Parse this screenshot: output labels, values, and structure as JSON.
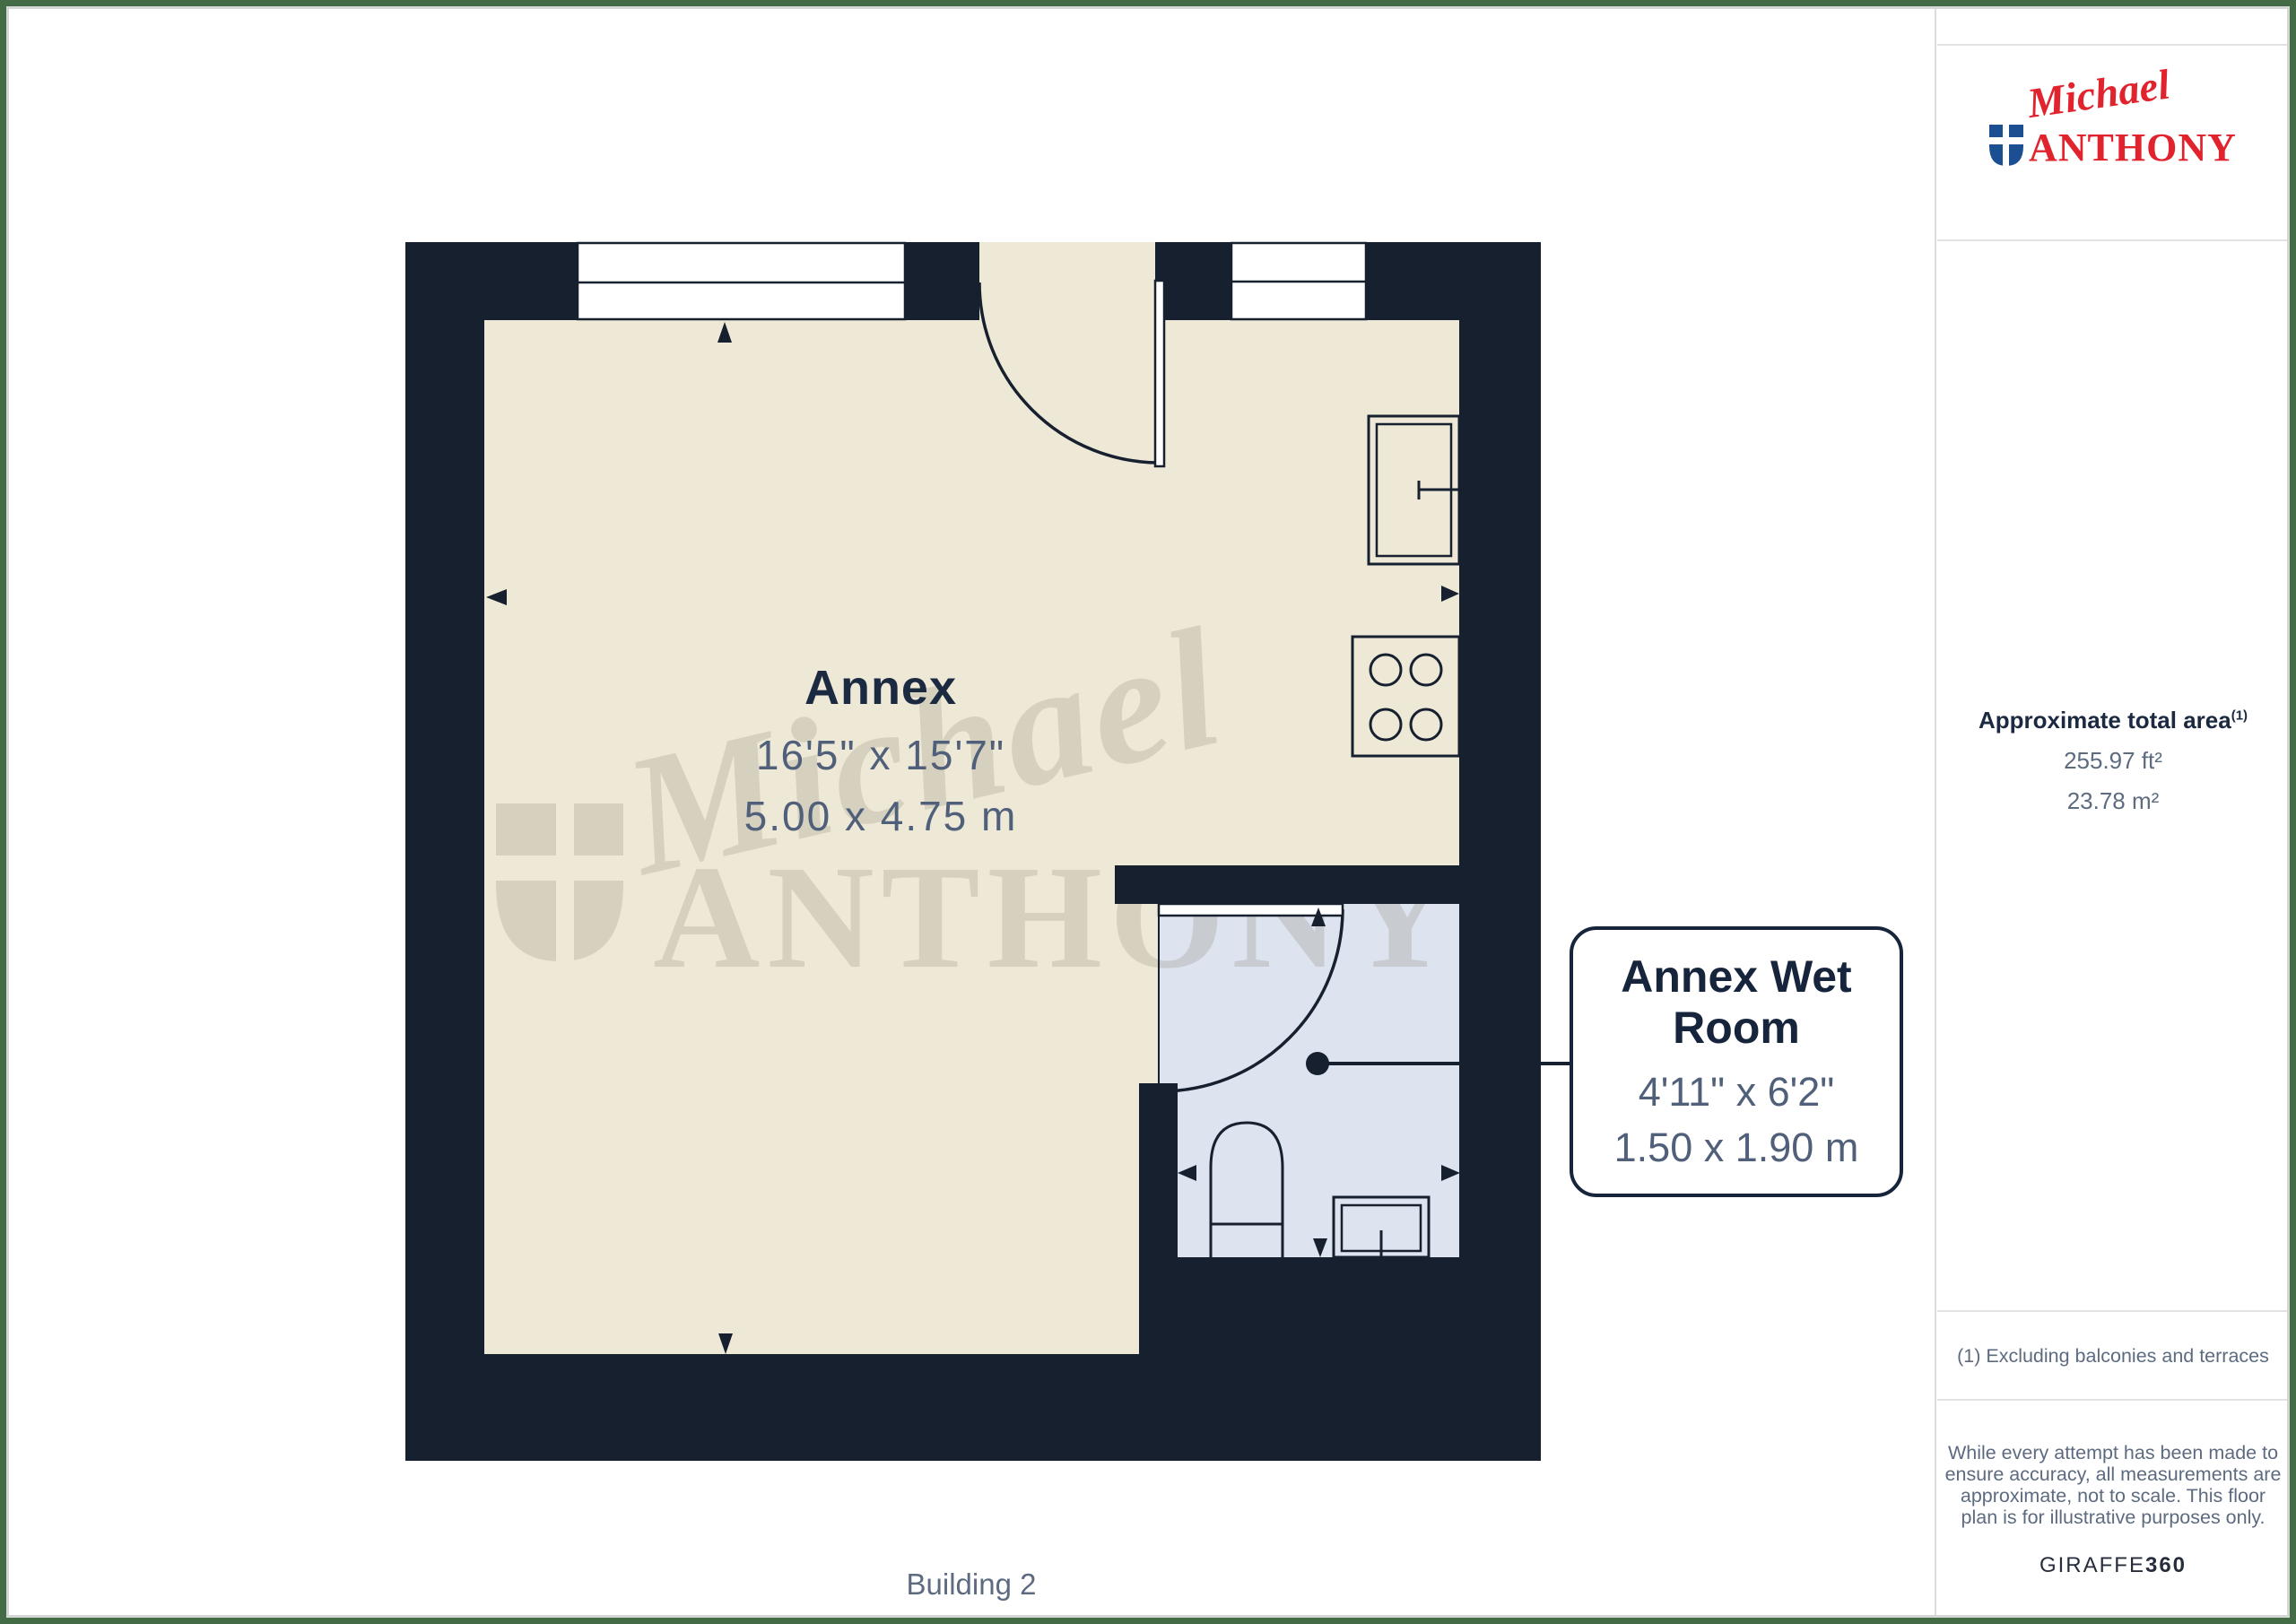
{
  "branding": {
    "script": "Michael",
    "name": "ANTHONY",
    "giraffe": "GIRAFFE",
    "giraffe_suffix": "360"
  },
  "sidebar": {
    "area_title": "Approximate total area",
    "area_superscript": "(1)",
    "area_ft": "255.97 ft²",
    "area_m": "23.78 m²",
    "note": "(1) Excluding balconies and terraces",
    "disclaimer_lines": [
      "While every attempt has been made to",
      "ensure accuracy, all measurements are",
      "approximate, not to scale. This floor",
      "plan is for illustrative purposes only."
    ]
  },
  "plan": {
    "building_label": "Building 2",
    "annex": {
      "name": "Annex",
      "dims_imperial": "16'5\" x 15'7\"",
      "dims_metric": "5.00 x 4.75 m"
    },
    "wet_room": {
      "name": "Annex Wet Room",
      "dims_imperial": "4'11\" x 6'2\"",
      "dims_metric": "1.50 x 1.90 m"
    }
  },
  "watermark": {
    "script": "Michael",
    "name": "ANTHONY"
  },
  "colors": {
    "wall": "#16202f",
    "floor_beige": "#eee8d7",
    "wet_room_blue": "#dde3ef",
    "label_navy": "#1b2a41",
    "dim_grey": "#51607a",
    "logo_red": "#e1232e",
    "shield_blue": "#1c4e92",
    "border_green": "#426b46"
  }
}
